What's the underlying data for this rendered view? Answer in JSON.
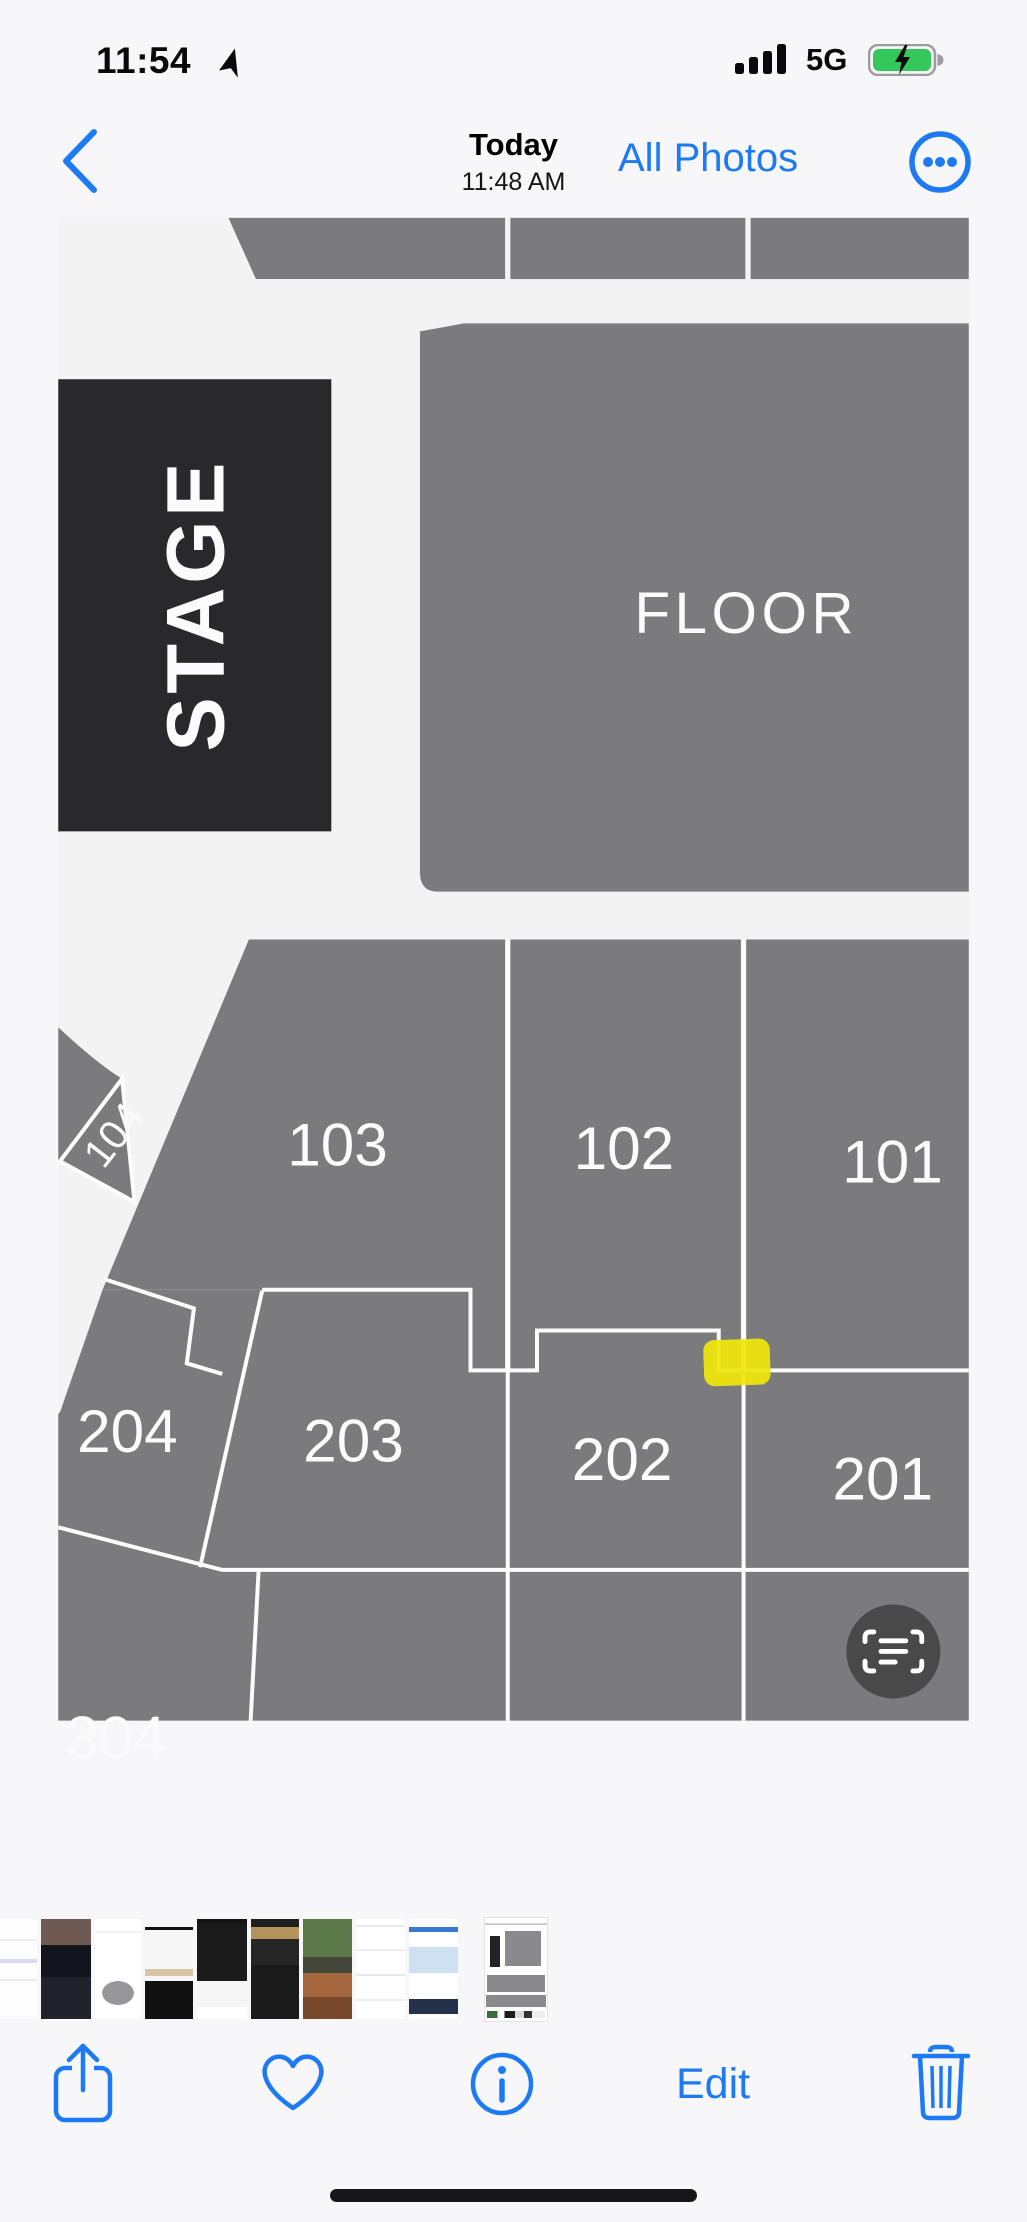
{
  "status_bar": {
    "time": "11:54",
    "network": "5G",
    "icons": {
      "location": "location-arrow-icon",
      "signal": "cellular-signal-icon",
      "battery": "battery-charging-icon"
    }
  },
  "nav_bar": {
    "back_icon": "chevron-left-icon",
    "date_label": "Today",
    "time_label": "11:48 AM",
    "all_photos_label": "All Photos",
    "more_icon": "ellipsis-circle-icon"
  },
  "photo": {
    "seating_map": {
      "stage_label": "STAGE",
      "floor_label": "FLOOR",
      "sections": {
        "s104": "104",
        "s103": "103",
        "s102": "102",
        "s101": "101",
        "s204": "204",
        "s203": "203",
        "s202": "202",
        "s201": "201",
        "s304": "304"
      }
    },
    "live_text_icon": "live-text-scan-icon"
  },
  "toolbar": {
    "share_icon": "share-icon",
    "favorite_icon": "heart-icon",
    "info_icon": "info-circle-icon",
    "edit_label": "Edit",
    "delete_icon": "trash-icon"
  },
  "colors": {
    "accent_blue": "#1d7af2",
    "section_gray": "#7b7a7d",
    "stage_dark": "#29282c",
    "map_line": "#fcfcfc",
    "highlight_yellow": "#efe50c",
    "battery_green": "#34c759"
  }
}
